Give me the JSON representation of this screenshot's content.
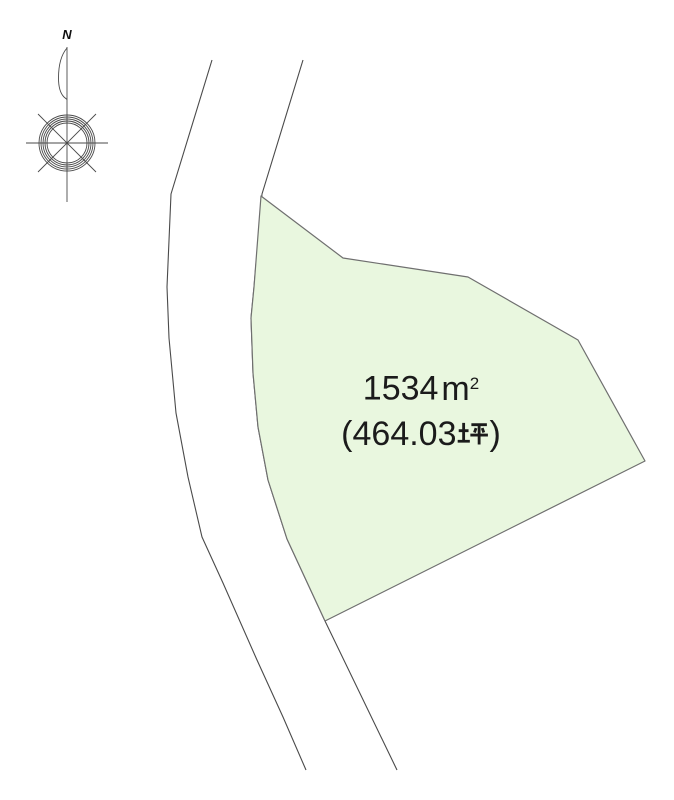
{
  "compass": {
    "north_label": "N"
  },
  "site_plan": {
    "road": {
      "line_color": "#4a4a4a"
    },
    "parcel": {
      "area_sqm_label": "1534㎡",
      "area_tsubo_label": "(464.03坪)",
      "fill_color": "#e9f7df",
      "border_color": "#6f6f6f",
      "display": {
        "area_value": "1534",
        "area_unit_base": "m",
        "area_unit_exponent": "2",
        "tsubo_prefix": "(464.03",
        "tsubo_kanji": "坪",
        "tsubo_suffix": ")"
      }
    }
  }
}
